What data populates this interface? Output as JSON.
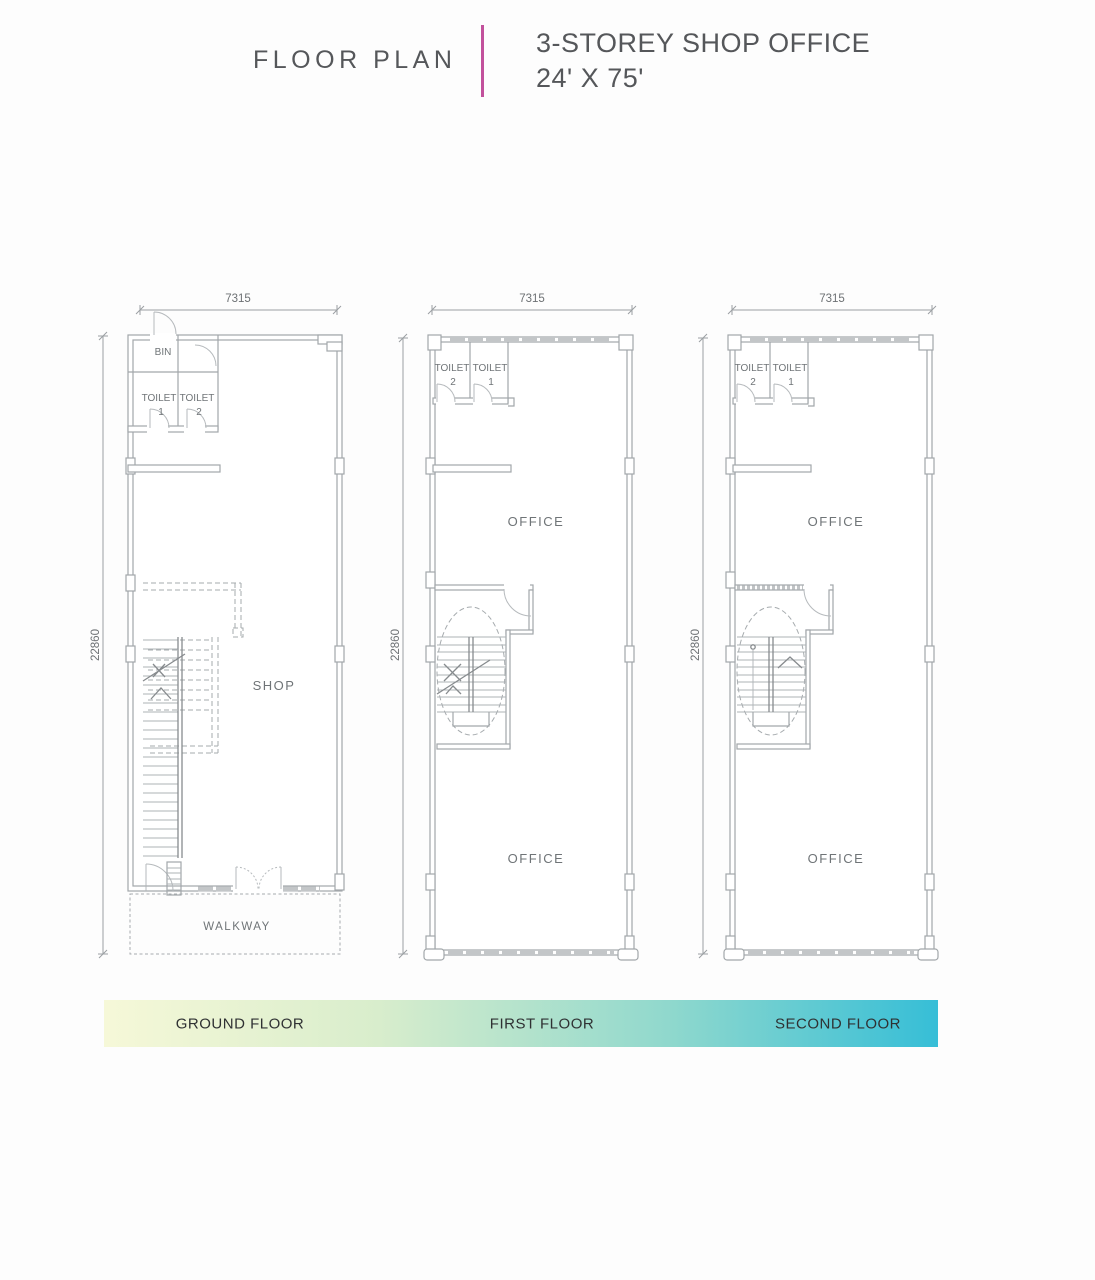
{
  "header": {
    "title_left": "FLOOR PLAN",
    "title_line1": "3-STOREY SHOP OFFICE",
    "title_line2": "24' X 75'",
    "divider_color": "#c2519c"
  },
  "plans": {
    "ground": {
      "width_dim": "7315",
      "depth_dim": "22860",
      "bin": "BIN",
      "toilet_left_label": "TOILET",
      "toilet_left_num": "1",
      "toilet_right_label": "TOILET",
      "toilet_right_num": "2",
      "shop": "SHOP",
      "walkway": "WALKWAY"
    },
    "first": {
      "width_dim": "7315",
      "depth_dim": "22860",
      "toilet_left_label": "TOILET",
      "toilet_left_num": "2",
      "toilet_right_label": "TOILET",
      "toilet_right_num": "1",
      "office_top": "OFFICE",
      "office_bottom": "OFFICE"
    },
    "second": {
      "width_dim": "7315",
      "depth_dim": "22860",
      "toilet_left_label": "TOILET",
      "toilet_left_num": "2",
      "toilet_right_label": "TOILET",
      "toilet_right_num": "1",
      "office_top": "OFFICE",
      "office_bottom": "OFFICE"
    }
  },
  "legend": {
    "gradient_start": "#f6f8d8",
    "gradient_end": "#36bed7",
    "items": [
      {
        "label": "GROUND FLOOR"
      },
      {
        "label": "FIRST FLOOR"
      },
      {
        "label": "SECOND FLOOR"
      }
    ]
  }
}
